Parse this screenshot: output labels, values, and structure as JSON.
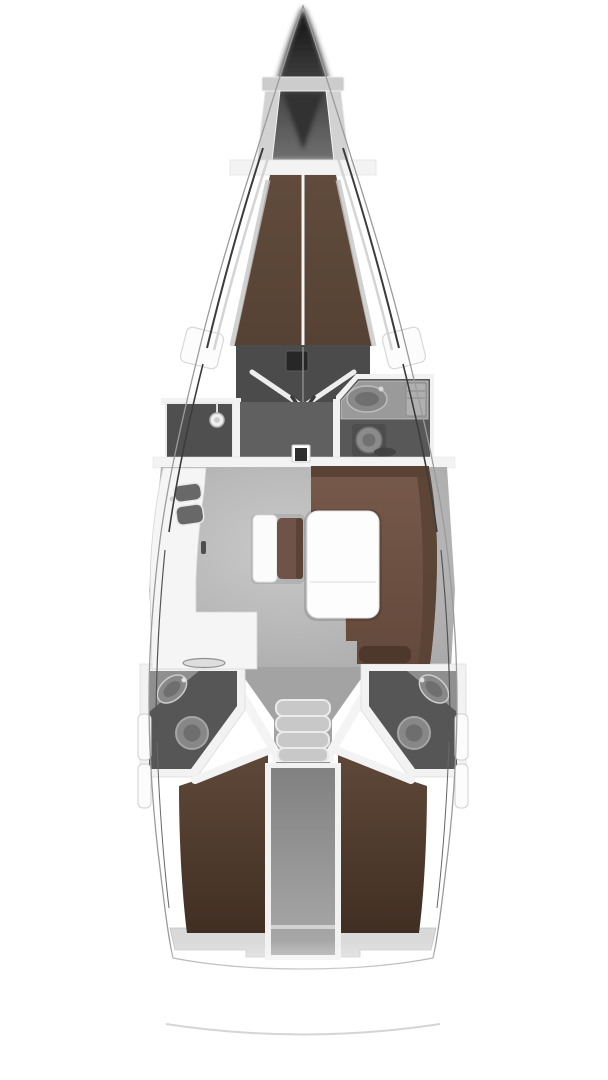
{
  "diagram": {
    "type": "yacht-floor-plan",
    "view": "top-down",
    "orientation": "bow-up",
    "regions": [
      "anchor-locker",
      "forward-cabin-v-berth",
      "forward-cabin-entry",
      "shower-room",
      "forward-head",
      "saloon",
      "galley",
      "settee",
      "saloon-table",
      "companionway-steps",
      "port-aft-head",
      "starboard-aft-head",
      "port-aft-cabin-berth",
      "starboard-aft-cabin-berth",
      "engine-compartment",
      "transom"
    ],
    "fixtures": [
      "galley-sinks",
      "stove",
      "shower-head",
      "wash-basin-forward",
      "wash-basin-port",
      "wash-basin-starboard",
      "toilet-forward",
      "toilet-port",
      "toilet-starboard",
      "mast-post",
      "saloon-table",
      "companionway-steps"
    ]
  },
  "colors": {
    "bg": "#ffffff",
    "hull_stroke": "#9b9b9b",
    "sheer_dark": "#3c3c3c",
    "sheer_soft": "#cfcfcf",
    "bow_top": "#111111",
    "bow_bottom": "#707070",
    "frame_light": "#d2d2d2",
    "frame_band": "#cccccc",
    "locker_dark": "#303030",
    "bulkhead": "#f3f3f3",
    "vberth_top": "#604b3c",
    "vberth_bottom": "#564234",
    "center_line": "#f6f6f6",
    "foot_dark": "#4b4b4b",
    "hatch_dark": "#272727",
    "door_line": "#ededed",
    "door_arrow": "#3a3a3a",
    "wall_white": "#f2f2f2",
    "shower_floor": "#4f4f4f",
    "shower_head_fill": "#eeeeee",
    "corridor_floor": "#606060",
    "head_floor": "#585858",
    "counter_gray": "#9a9a9a",
    "cabinet_gray": "#b0b0b0",
    "sink_light": "#888888",
    "sink_inner": "#6f6f6f",
    "toilet_dark": "#4d4d4d",
    "toilet_light": "#8b8b8b",
    "floor_light": "#c9c9c9",
    "floor_dark": "#a4a4a4",
    "galley_white": "#f5f5f5",
    "galley_sink": "#686868",
    "stove_fill": "#dedede",
    "stove_stroke": "#909090",
    "settee_top": "#76594a",
    "settee_bottom": "#644a3c",
    "backrest": "#5a4335",
    "pillow": "#4d382b",
    "table_white": "#fdfdfd",
    "bench_white": "#fbfbfb",
    "bench_cushion": "#6e5346",
    "mast_dark": "#2e2e2e",
    "vent_dark": "#404040",
    "aft_corridor": "#a3a3a3",
    "step_gray": "#c8c8c8",
    "step_dark": "#8e8e8e",
    "aft_head_floor": "#565656",
    "aft_counter": "#8f8f8f",
    "aft_toilet": "#878787",
    "engine_dark": "#818181",
    "engine_light": "#aaaaaa",
    "engine_line": "#d3d3d3",
    "aft_berth_top": "#5f4839",
    "aft_berth_bottom": "#412f23",
    "shelf_gray": "#d9d9d9",
    "panel_white": "#fcfcfc",
    "stern_arc": "#d5d5d5"
  }
}
